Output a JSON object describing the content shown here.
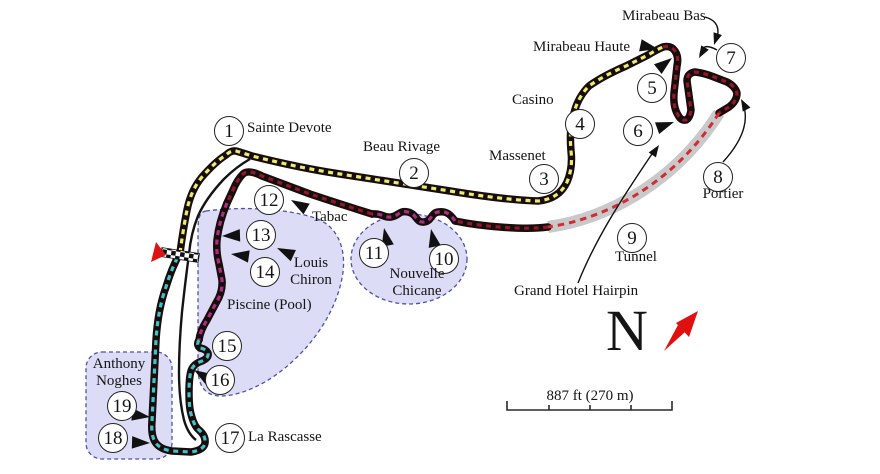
{
  "corners": [
    {
      "n": "1"
    },
    {
      "n": "2"
    },
    {
      "n": "3"
    },
    {
      "n": "4"
    },
    {
      "n": "5"
    },
    {
      "n": "6"
    },
    {
      "n": "7"
    },
    {
      "n": "8"
    },
    {
      "n": "9"
    },
    {
      "n": "10"
    },
    {
      "n": "11"
    },
    {
      "n": "12"
    },
    {
      "n": "13"
    },
    {
      "n": "14"
    },
    {
      "n": "15"
    },
    {
      "n": "16"
    },
    {
      "n": "17"
    },
    {
      "n": "18"
    },
    {
      "n": "19"
    }
  ],
  "labels": {
    "sainte_devote": "Sainte Devote",
    "beau_rivage": "Beau Rivage",
    "massenet": "Massenet",
    "casino": "Casino",
    "mirabeau_haute": "Mirabeau Haute",
    "mirabeau_bas": "Mirabeau Bas",
    "portier": "Portier",
    "tunnel": "Tunnel",
    "grand_hotel_hairpin": "Grand Hotel Hairpin",
    "nouvelle_chicane": "Nouvelle\nChicane",
    "tabac": "Tabac",
    "louis_chiron": "Louis\nChiron",
    "piscine": "Piscine (Pool)",
    "la_rascasse": "La Rascasse",
    "anthony_noghes": "Anthony\nNoghes"
  },
  "compass": {
    "north_letter": "N"
  },
  "scale_bar": {
    "label": "887 ft (270 m)"
  },
  "colors": {
    "sector1_yellow": "#e7ee6d",
    "sector2_dark_red": "#8c1a28",
    "chicane_magenta": "#a53080",
    "sector3_teal": "#3ec3c6",
    "tunnel_grey": "#c9c9c9",
    "tunnel_dash_red": "#d42b33",
    "zone_fill": "#dcdcf6",
    "zone_border": "#5050a8",
    "track_casing": "#190c0c",
    "flag_red": "#dc1414",
    "north_arrow_red": "#e01010",
    "ink": "#111111"
  }
}
